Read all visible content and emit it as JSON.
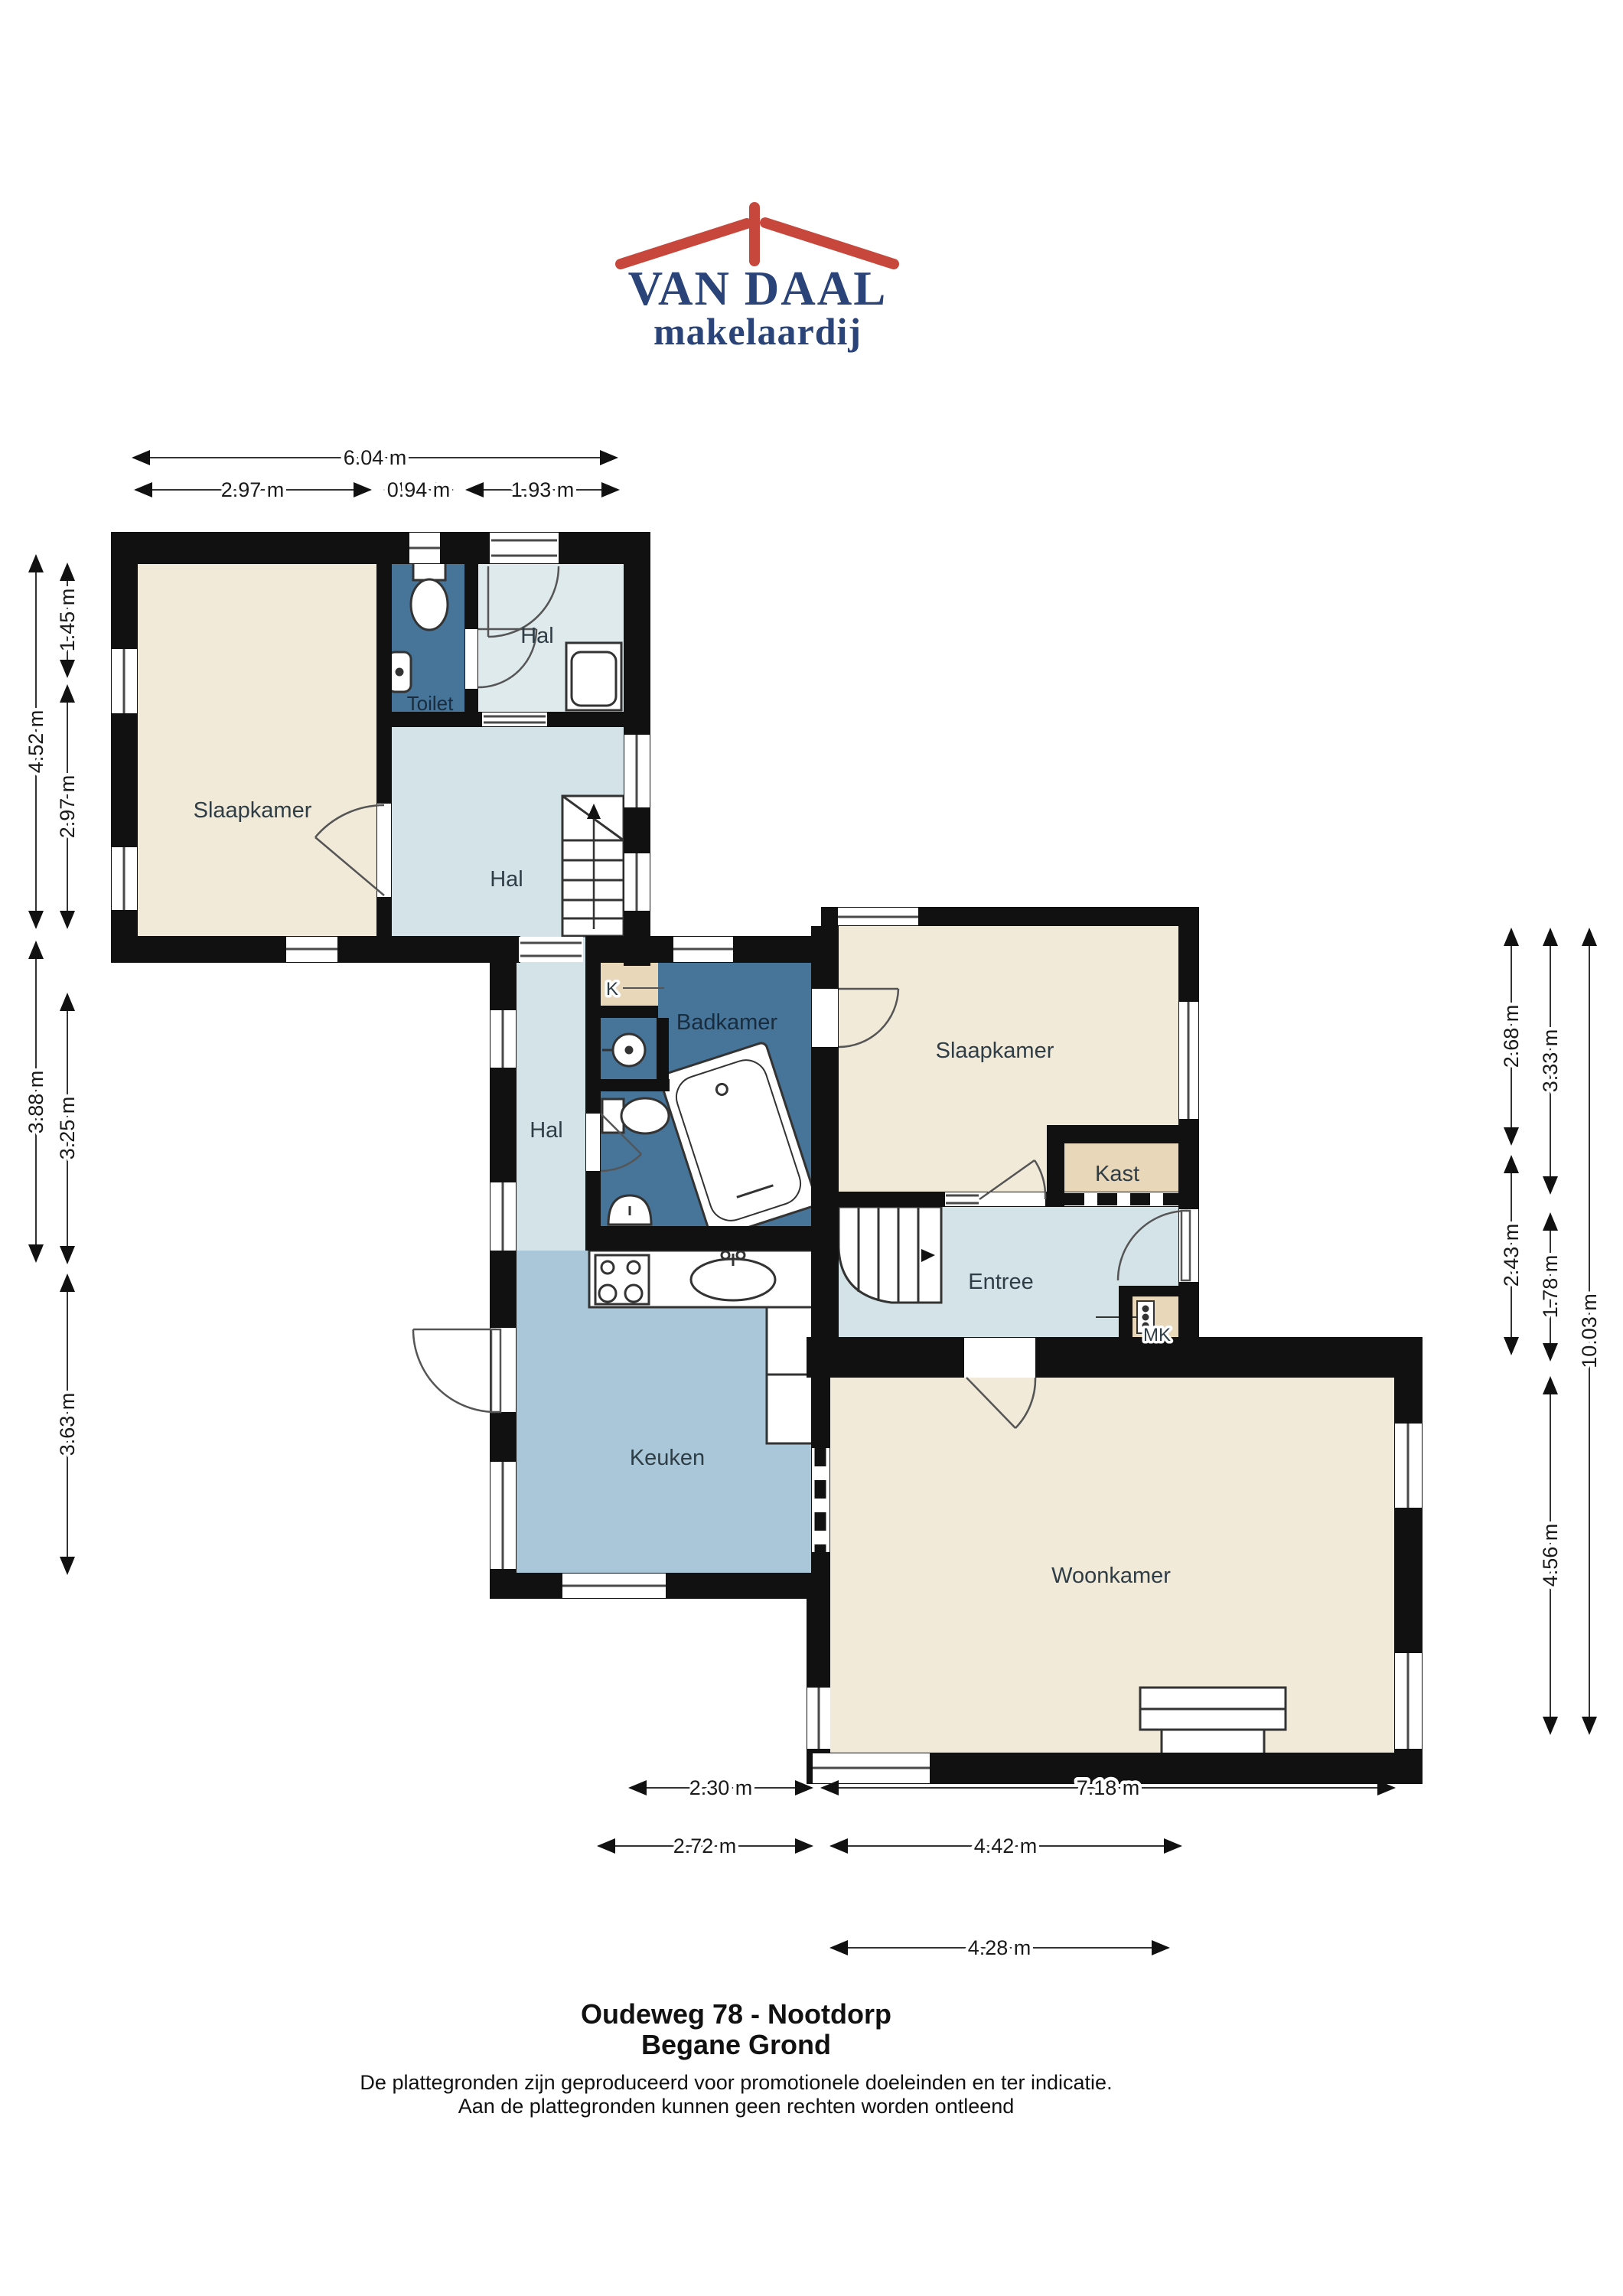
{
  "logo": {
    "name": "VAN DAAL",
    "tagline": "makelaardij",
    "colors": {
      "blue": "#2a4379",
      "red": "#c7473d"
    }
  },
  "floorplan": {
    "rooms": [
      {
        "label": "Slaapkamer"
      },
      {
        "label": "Toilet"
      },
      {
        "label": "Hal"
      },
      {
        "label": "Hal"
      },
      {
        "label": "K"
      },
      {
        "label": "Badkamer"
      },
      {
        "label": "Slaapkamer"
      },
      {
        "label": "Kast"
      },
      {
        "label": "Hal"
      },
      {
        "label": "Entree"
      },
      {
        "label": "Keuken"
      },
      {
        "label": "Woonkamer"
      },
      {
        "label": "MK"
      }
    ],
    "colors": {
      "wall": "#111111",
      "bedroom": "#f2ead9",
      "bathroom": "#47759a",
      "hall_light": "#dfeaec",
      "hall": "#d4e3e8",
      "kitchen": "#a9c7d8",
      "closet": "#e8d7b9"
    }
  },
  "dimensions": {
    "top": [
      "6.04 m",
      "2.97 m",
      "0.94 m",
      "1.93 m"
    ],
    "left": [
      "4.52 m",
      "3.88 m",
      "1.45 m",
      "2.97 m",
      "3.25 m",
      "3.63 m"
    ],
    "right": [
      "2.68 m",
      "2.43 m",
      "3.33 m",
      "1.78 m",
      "4.56 m",
      "10.03 m"
    ],
    "bottom": [
      "2.30 m",
      "7.18 m",
      "2.72 m",
      "4.42 m",
      "4.28 m"
    ]
  },
  "footer": {
    "address": "Oudeweg 78 - Nootdorp",
    "floor": "Begane Grond",
    "disclaimer_line1": "De plattegronden zijn geproduceerd voor promotionele doeleinden en ter indicatie.",
    "disclaimer_line2": "Aan de plattegronden kunnen geen rechten worden ontleend"
  }
}
